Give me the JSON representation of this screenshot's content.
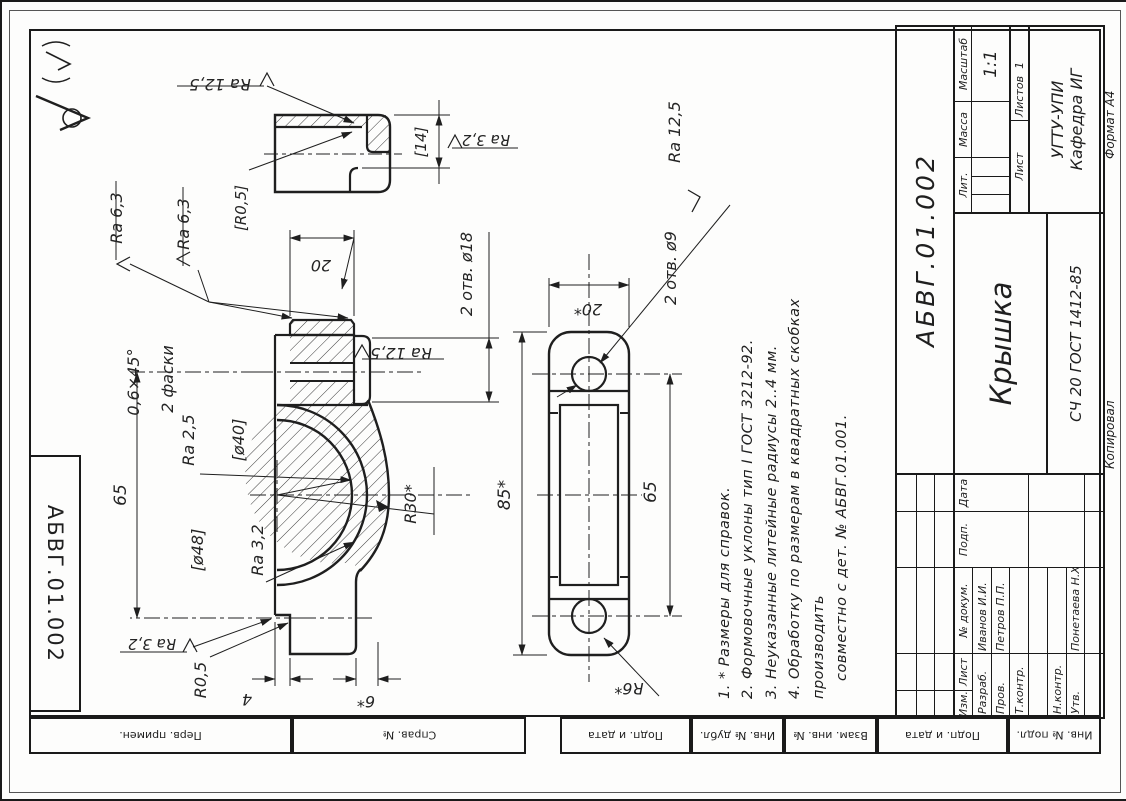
{
  "titleblock": {
    "designation": "АБВГ.01.002",
    "name": "Крышка",
    "material": "СЧ 20 ГОСТ 1412-85",
    "letters_label": "Лит.",
    "mass_label": "Масса",
    "scale_label": "Масштаб",
    "scale_value": "1:1",
    "sheet_label": "Лист",
    "sheets_label": "Листов",
    "sheets_value": "1",
    "org_line1": "УГТУ-УПИ",
    "org_line2": "Кафедра ИГ",
    "rev_headers": {
      "izm": "Изм.",
      "list": "Лист",
      "doc": "№ докум.",
      "sign": "Подп.",
      "date": "Дата"
    },
    "rows": {
      "developed": "Разраб.",
      "checked": "Пров.",
      "tcontrol": "Т.контр.",
      "ncontrol": "Н.контр.",
      "approved": "Утв."
    },
    "people": {
      "developed": "Иванов И.И.",
      "checked": "Петров П.П.",
      "approved": "Понетаева Н.Х."
    },
    "copied_label": "Копировал",
    "format_label": "Формат А4"
  },
  "corner_designation": "АБВГ.01.002",
  "margin_stamps": {
    "perv": "Перв. примен.",
    "sprav": "Справ. №",
    "podp1": "Подп. и дата",
    "inv_dubl": "Инв. № дубл.",
    "vzam": "Взам. инв. №",
    "podp2": "Подп. и дата",
    "inv_podl": "Инв. № подл."
  },
  "notes": {
    "l1": "1. * Размеры для справок.",
    "l2": "2. Формовочные уклоны тип I ГОСТ 3212-92.",
    "l3": "3. Неуказанные литейные радиусы 2..4 мм.",
    "l4": "4. Обработку  по  размерам  в  квадратных  скобках  производить",
    "l5": "совместно с дет. № АБВГ.01.001."
  },
  "surface": {
    "others_note": "(√)"
  },
  "dims": {
    "d20": "20",
    "d20s": "20*",
    "d65": "65",
    "d85": "85*",
    "d4": "4",
    "d6": "6*",
    "d14": "[14]",
    "d40": "[ø40]",
    "d48": "[ø48]",
    "r30": "R30*",
    "r6": "R6*",
    "r05": "R0,5",
    "r05b": "[R0,5]",
    "otv18": "2 отв. ø18",
    "otv9": "2 отв. ø9",
    "chamfer": "0,6×45°",
    "chamfer2": "2 фаски",
    "ra125": "Ra 12,5",
    "ra63": "Ra 6,3",
    "ra32": "Ra 3,2",
    "ra25": "Ra 2,5"
  }
}
